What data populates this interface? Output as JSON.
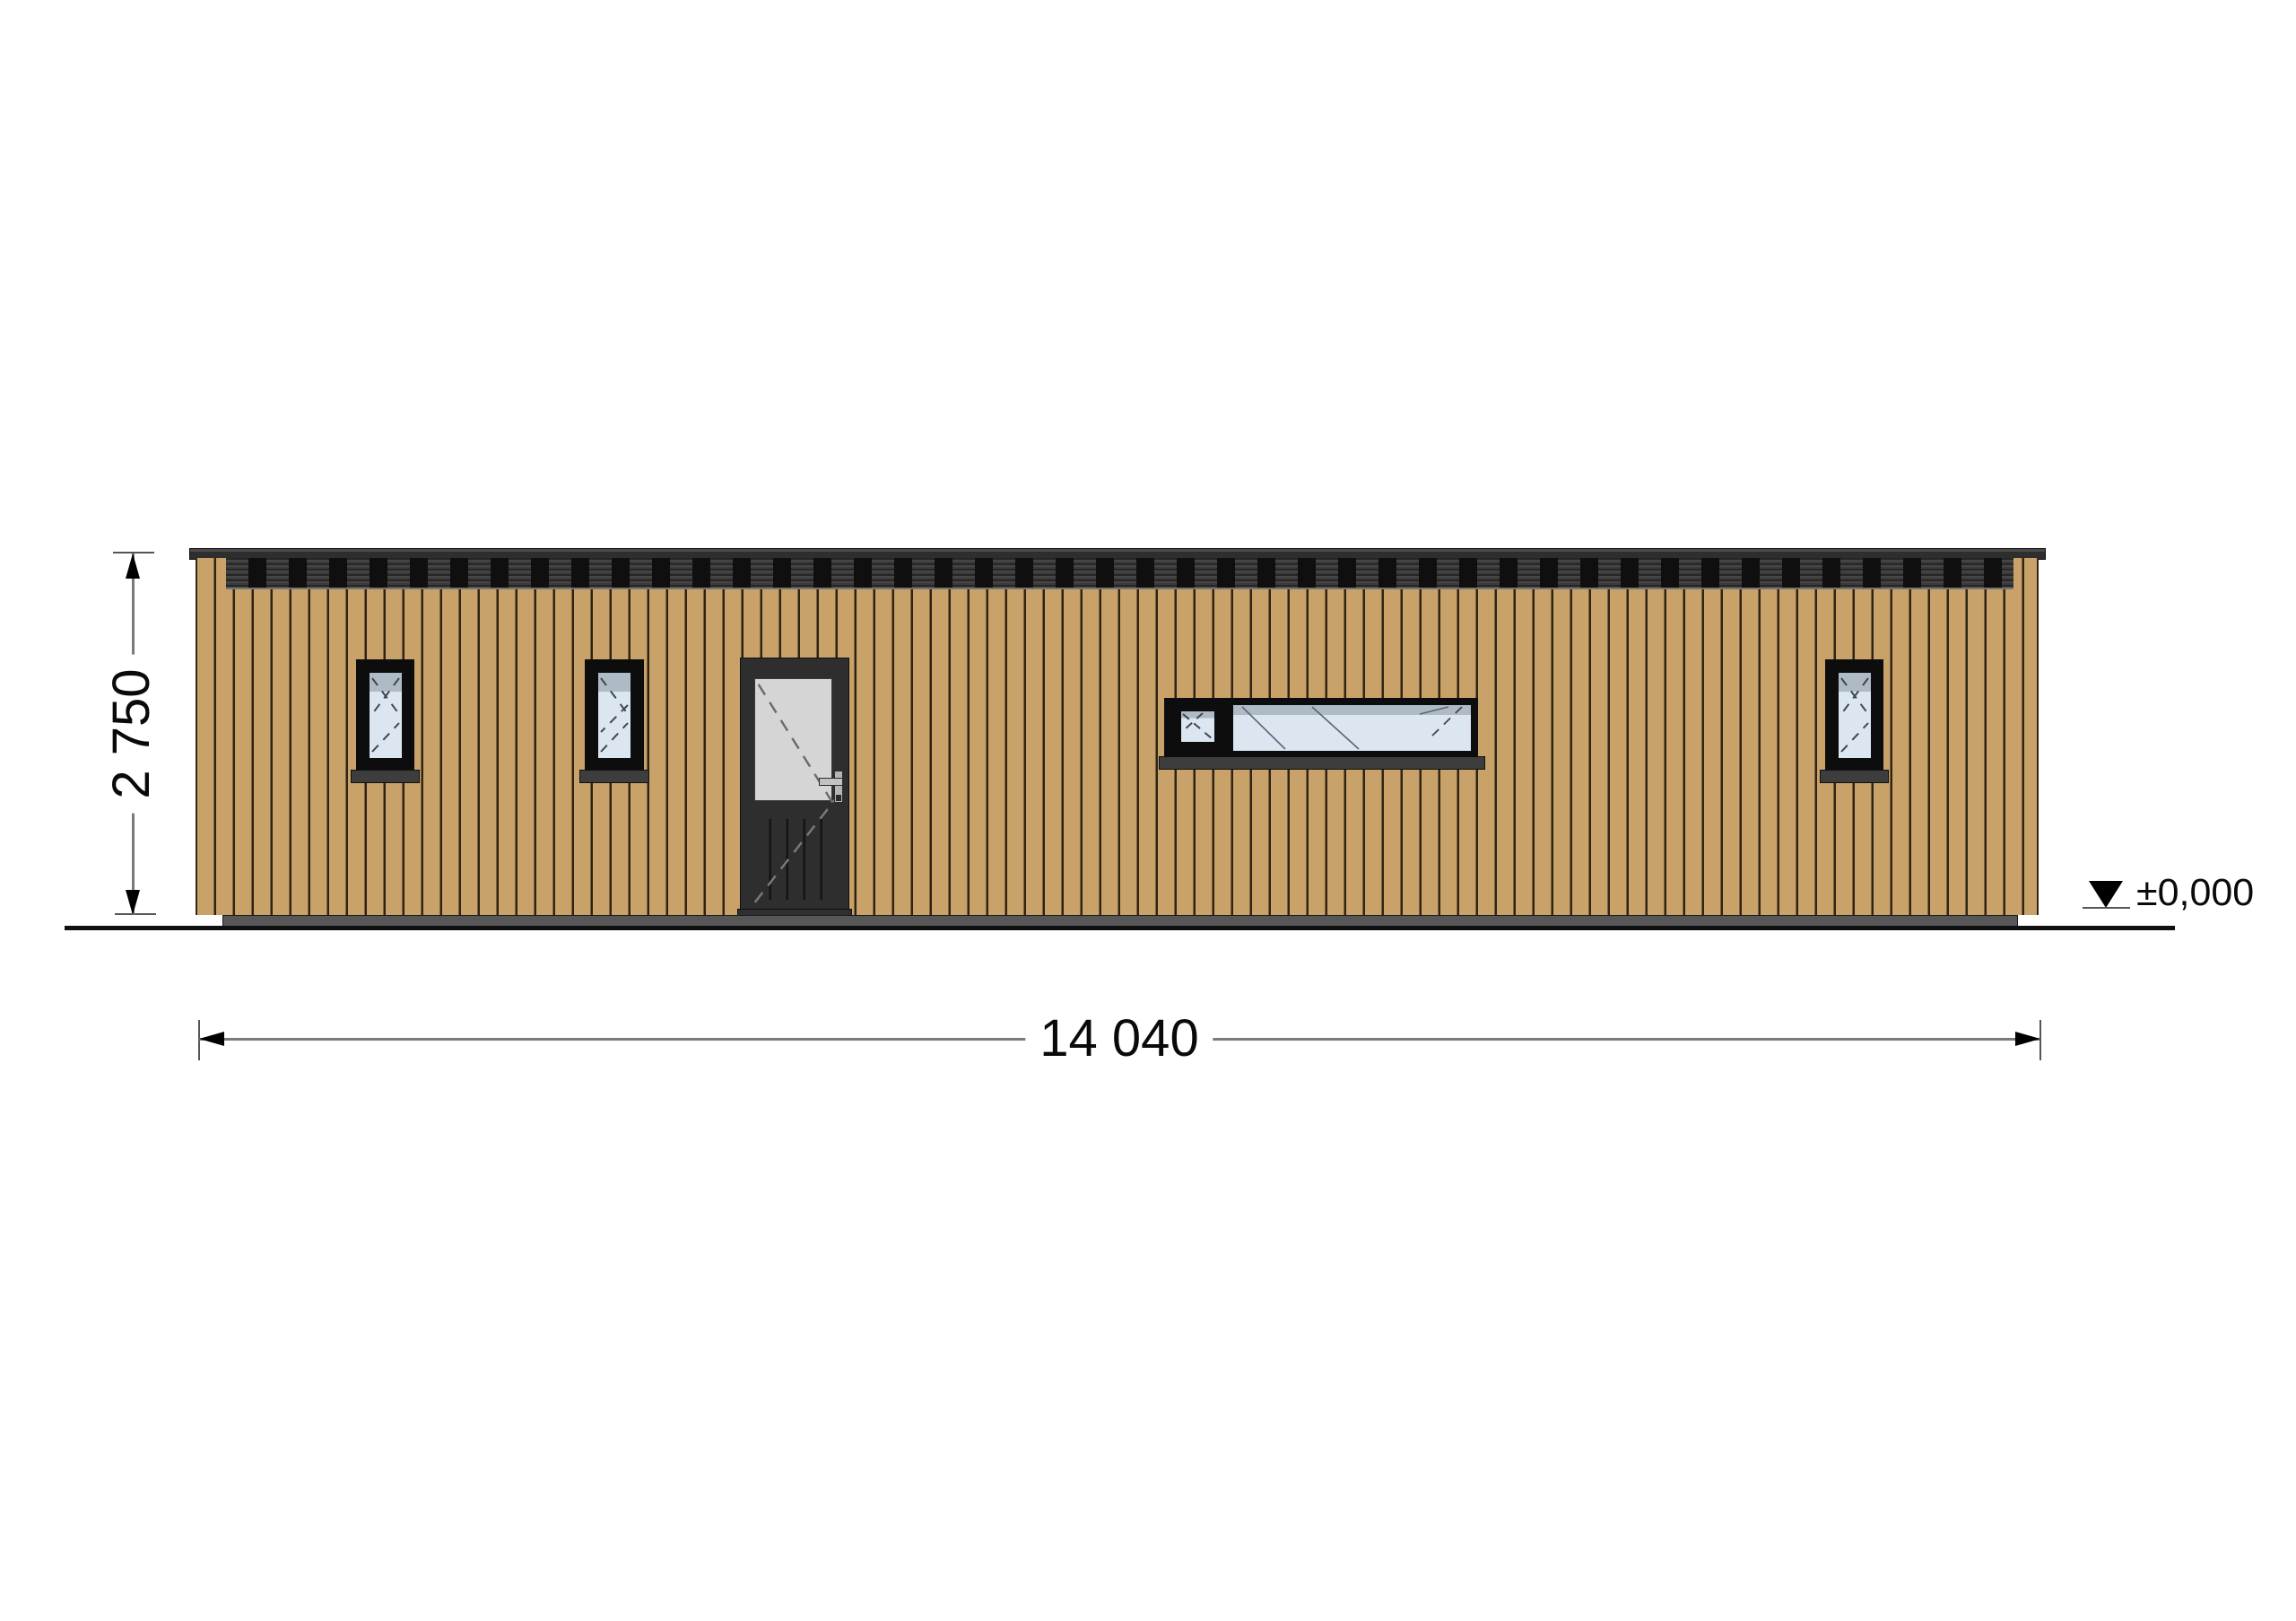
{
  "drawing": {
    "labels": {
      "height_dimension": "2 750",
      "width_dimension": "14 040",
      "ground_level": "±0,000"
    },
    "colors": {
      "wood": "#C8A268",
      "wood_line": "#2E2416",
      "band": "#3A3A3A",
      "band_bar": "#0F0F0F",
      "frame": "#0D0D0D",
      "glass": "#DCE6F1",
      "glass_shadow": "#AFBAC7",
      "door": "#2E2E2E",
      "door_glass": "#D5D5D5",
      "sill": "#3D3D3D",
      "base": "#575757",
      "ground": "#101010",
      "dim": "#7A7A7A"
    }
  }
}
